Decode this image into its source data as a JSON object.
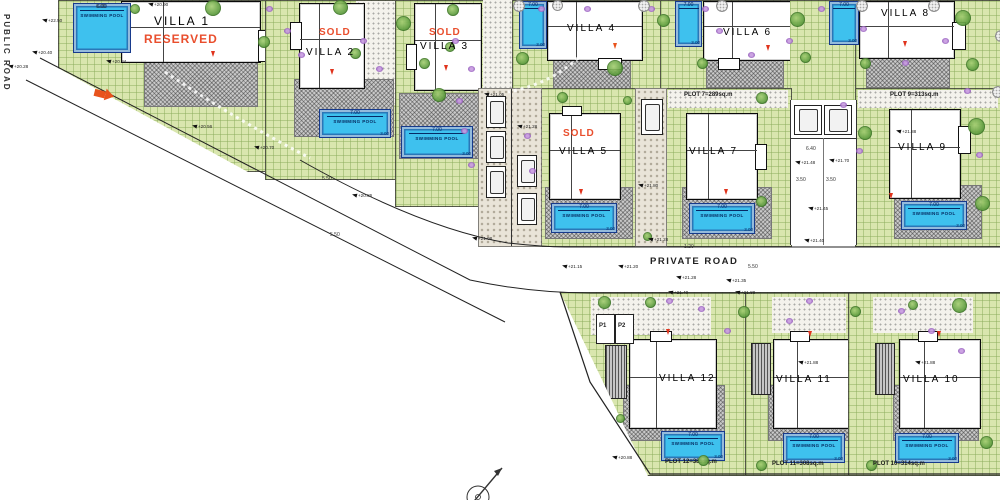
{
  "drawing": {
    "roads": {
      "public": "PUBLIC ROAD",
      "private": "PRIVATE ROAD"
    },
    "villas": [
      {
        "name": "VILLA 1",
        "status": "RESERVED"
      },
      {
        "name": "VILLA 2",
        "status": "SOLD"
      },
      {
        "name": "VILLA 3",
        "status": "SOLD"
      },
      {
        "name": "VILLA 4",
        "status": ""
      },
      {
        "name": "VILLA 6",
        "status": ""
      },
      {
        "name": "VILLA 8",
        "status": ""
      },
      {
        "name": "VILLA 5",
        "status": "SOLD"
      },
      {
        "name": "VILLA 7",
        "status": ""
      },
      {
        "name": "VILLA 9",
        "status": ""
      },
      {
        "name": "VILLA 12",
        "status": ""
      },
      {
        "name": "VILLA 11",
        "status": ""
      },
      {
        "name": "VILLA 10",
        "status": ""
      }
    ],
    "plot_captions": {
      "plot7": "PLOT 7=289sq.m",
      "plot9": "PLOT 9=313sq.m",
      "plot12": "PLOT 12=383sq.m",
      "plot11": "PLOT 11=308sq.m",
      "plot10": "PLOT 10=314sq.m"
    },
    "pool": {
      "label": "SWIMMING POOL",
      "length": "7.00",
      "width": "3.00",
      "length_villa1": "6.00"
    },
    "parking": {
      "p1": "P1",
      "p2": "P2"
    },
    "elevations": [
      {
        "t": "+20.90",
        "x": 148,
        "y": 2
      },
      {
        "t": "+22.50",
        "x": 42,
        "y": 18
      },
      {
        "t": "+20.84",
        "x": 106,
        "y": 59
      },
      {
        "t": "+20.40",
        "x": 32,
        "y": 50
      },
      {
        "t": "+20.28",
        "x": 8,
        "y": 64
      },
      {
        "t": "+20.56",
        "x": 192,
        "y": 124
      },
      {
        "t": "+20.70",
        "x": 254,
        "y": 145
      },
      {
        "t": "+20.86",
        "x": 352,
        "y": 193
      },
      {
        "t": "+21.08",
        "x": 472,
        "y": 236
      },
      {
        "t": "+21.05",
        "x": 484,
        "y": 92
      },
      {
        "t": "+21.28",
        "x": 517,
        "y": 124
      },
      {
        "t": "+21.28",
        "x": 648,
        "y": 237
      },
      {
        "t": "+21.15",
        "x": 562,
        "y": 264
      },
      {
        "t": "+21.20",
        "x": 618,
        "y": 264
      },
      {
        "t": "+21.28",
        "x": 676,
        "y": 275
      },
      {
        "t": "+21.35",
        "x": 726,
        "y": 278
      },
      {
        "t": "+21.40",
        "x": 668,
        "y": 290
      },
      {
        "t": "+21.88",
        "x": 735,
        "y": 290
      },
      {
        "t": "+21.80",
        "x": 638,
        "y": 183
      },
      {
        "t": "+21.48",
        "x": 795,
        "y": 160
      },
      {
        "t": "+21.70",
        "x": 829,
        "y": 158
      },
      {
        "t": "+21.45",
        "x": 808,
        "y": 206
      },
      {
        "t": "+21.40",
        "x": 804,
        "y": 238
      },
      {
        "t": "+21.88",
        "x": 896,
        "y": 129
      },
      {
        "t": "+21.88",
        "x": 798,
        "y": 360
      },
      {
        "t": "+21.88",
        "x": 915,
        "y": 360
      },
      {
        "t": "+20.88",
        "x": 612,
        "y": 455
      }
    ],
    "dims": [
      {
        "t": "6.00",
        "x": 96,
        "y": 4
      },
      {
        "t": "5.50",
        "x": 322,
        "y": 176
      },
      {
        "t": "5.50",
        "x": 748,
        "y": 264
      },
      {
        "t": "1.20",
        "x": 684,
        "y": 244
      },
      {
        "t": "6.40",
        "x": 806,
        "y": 146
      },
      {
        "t": "3.50",
        "x": 796,
        "y": 177
      },
      {
        "t": "3.50",
        "x": 826,
        "y": 177
      },
      {
        "t": "5.50",
        "x": 330,
        "y": 232
      }
    ],
    "colors": {
      "pool": "#3ec1ee",
      "garden": "#d9e6ae",
      "sold_red": "#e8401c",
      "tree_green": "#5d9c3e",
      "flower_purple": "#8a4fb5",
      "entrance_arrow": "#e8531c"
    }
  }
}
